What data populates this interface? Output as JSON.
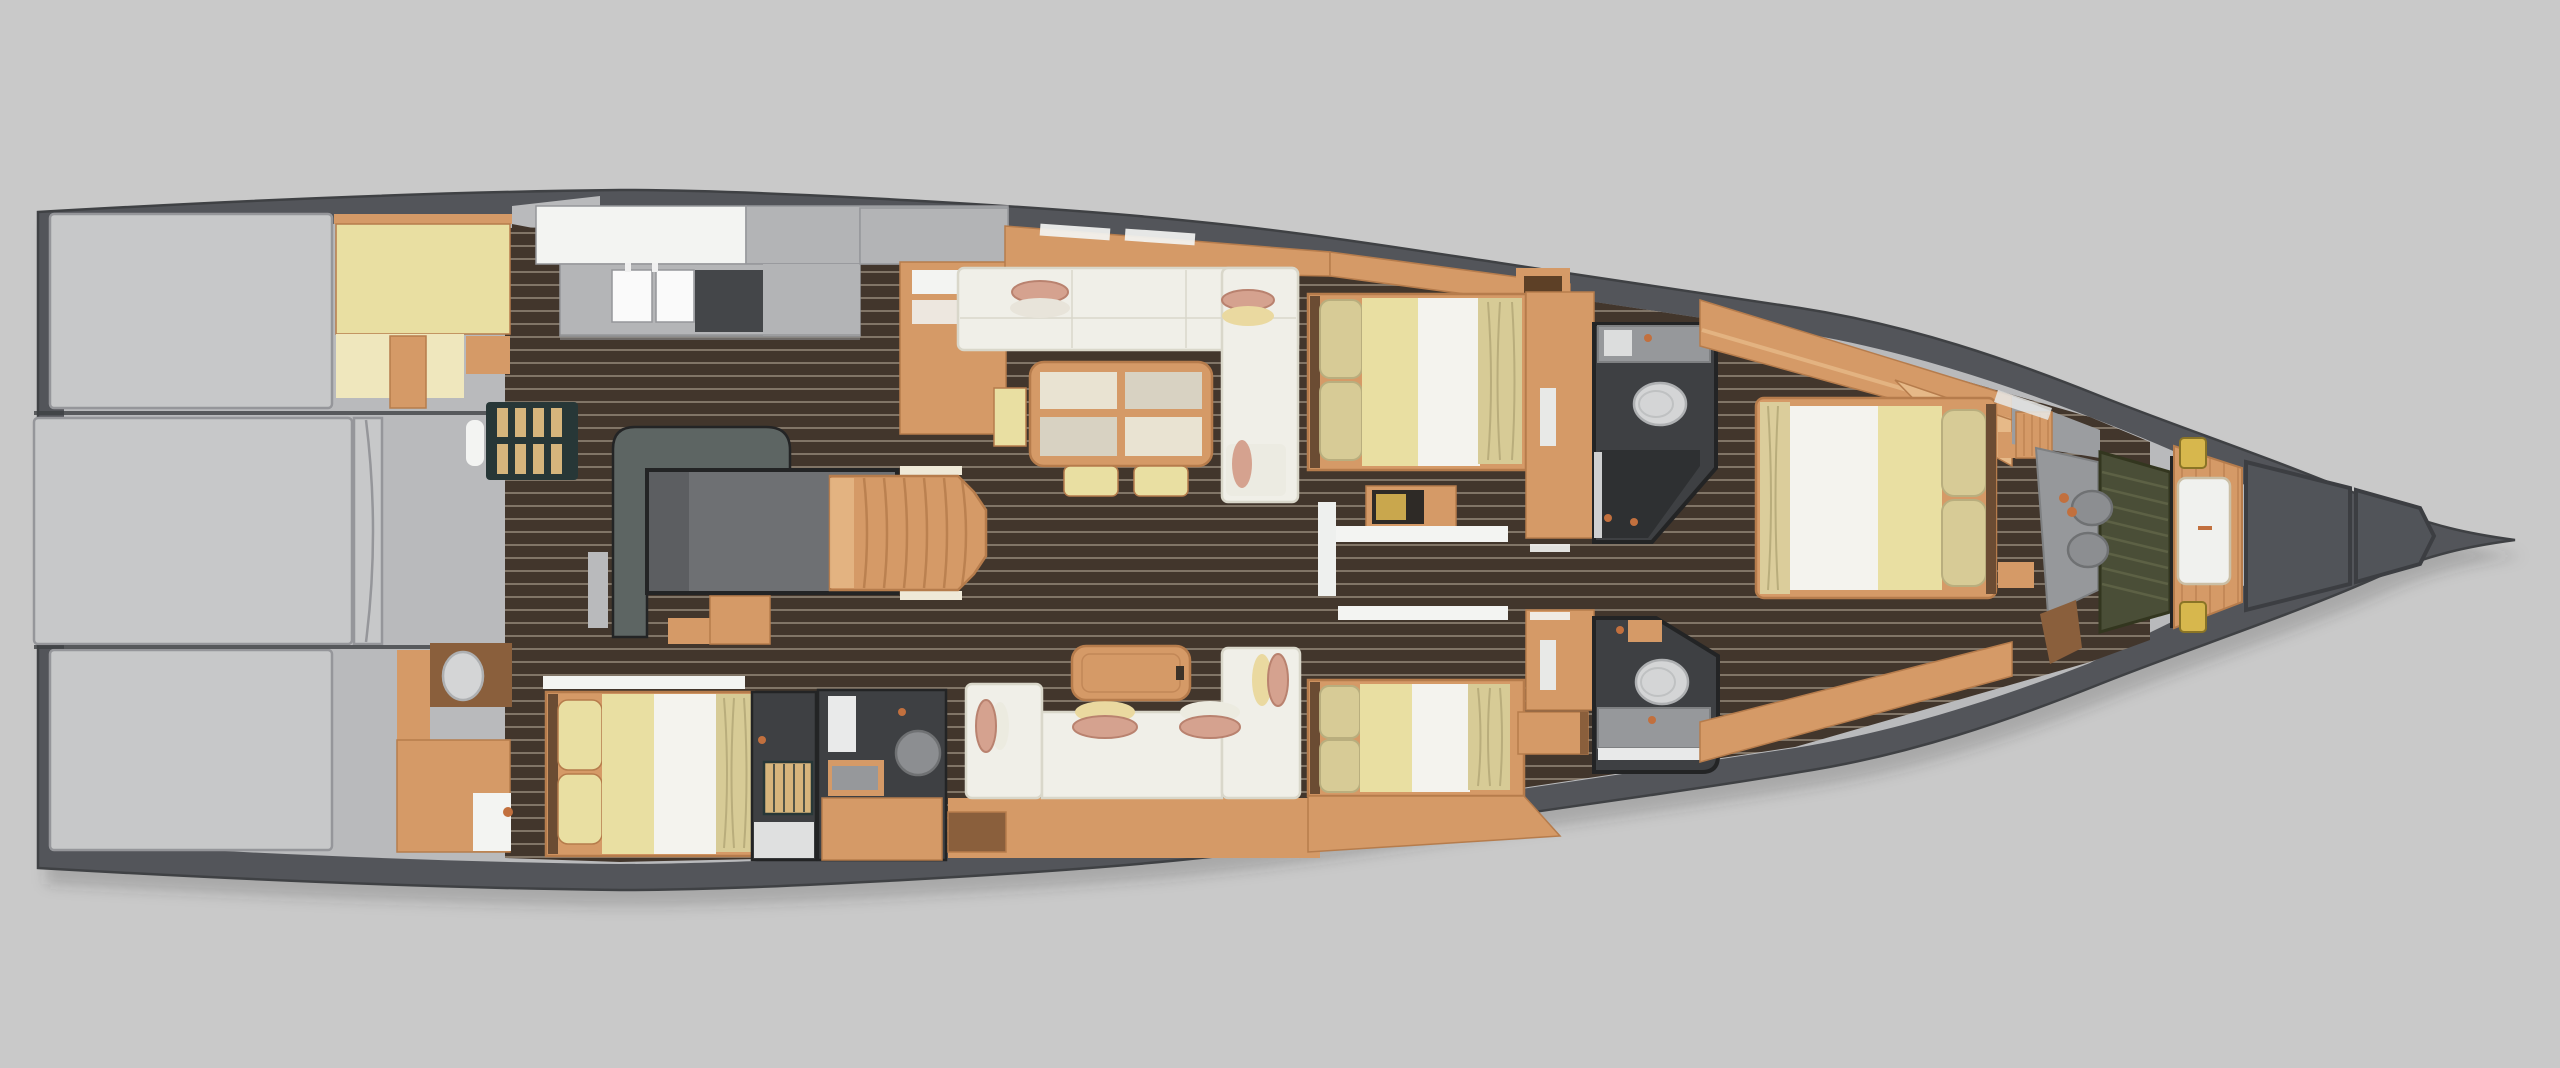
{
  "scene": {
    "title": "Sailing yacht interior layout — top-down 3D floor-plan render",
    "view": "top-down",
    "background": "#c9c9c9",
    "visible_text": ""
  },
  "palette": {
    "bg": "#c9c9c9",
    "hull": "#53555a",
    "hullEdge": "#3f4144",
    "interior": "#b9babc",
    "grayBox": "#c7c8c9",
    "gray2": "#b3b4b6",
    "seam": "#95969a",
    "dark": "#232425",
    "floor": "#42362c",
    "floorLine": "#a89b8a",
    "wood": "#d59a67",
    "woodDark": "#b67c4c",
    "woodPale": "#e6b988",
    "woodDeep": "#8a5f3c",
    "sofa": "#f0efe8",
    "sofaShade": "#d9d7ca",
    "duvet": "#f4f3ee",
    "bedYellow": "#e9dfa2",
    "bedPale": "#efe7bd",
    "pillowKhaki": "#d7cb96",
    "headboard": "#6b4c33",
    "pillowSalmon": "#d5a28f",
    "pillowCream": "#ead9a0",
    "pillowWhite": "#ecebe0",
    "marbleA": "#e9e3d2",
    "marbleB": "#d8d2c2",
    "slate": "#5d6563",
    "engine": "#6e7073",
    "bathWall": "#3e4043",
    "bathFloor": "#2e3032",
    "fixture": "#d4d5d6",
    "fixEdge": "#aeb0b2",
    "vanity": "#96989b",
    "basin": "#8c8e91",
    "olive": "#4a4e37",
    "oliveLine": "#5d6145",
    "grate": "#d6b57c",
    "grateFrame": "#273737",
    "stool": "#d7b74d",
    "copper": "#c2703e",
    "white": "#f3f4f2",
    "counter": "#b4b5b7",
    "cooktop": "#444649",
    "shadow": "rgba(50,50,55,0.22)"
  },
  "rooms": [
    {
      "id": "stern-lockers",
      "kind": "stowage"
    },
    {
      "id": "aft-crew-berth",
      "kind": "berth"
    },
    {
      "id": "aft-head",
      "kind": "bathroom"
    },
    {
      "id": "galley",
      "kind": "kitchen"
    },
    {
      "id": "nav-engine-area",
      "kind": "utility"
    },
    {
      "id": "companionway-steps",
      "kind": "stairs"
    },
    {
      "id": "salon-dining",
      "kind": "living"
    },
    {
      "id": "aft-cabin-port",
      "kind": "cabin"
    },
    {
      "id": "guest-cabin-starboard",
      "kind": "cabin"
    },
    {
      "id": "guest-head-starboard",
      "kind": "bathroom"
    },
    {
      "id": "guest-cabin-port",
      "kind": "cabin"
    },
    {
      "id": "guest-head-port",
      "kind": "bathroom"
    },
    {
      "id": "master-cabin",
      "kind": "cabin"
    },
    {
      "id": "master-bathroom",
      "kind": "bathroom"
    },
    {
      "id": "forepeak",
      "kind": "berth"
    },
    {
      "id": "bow-lockers",
      "kind": "stowage"
    }
  ]
}
